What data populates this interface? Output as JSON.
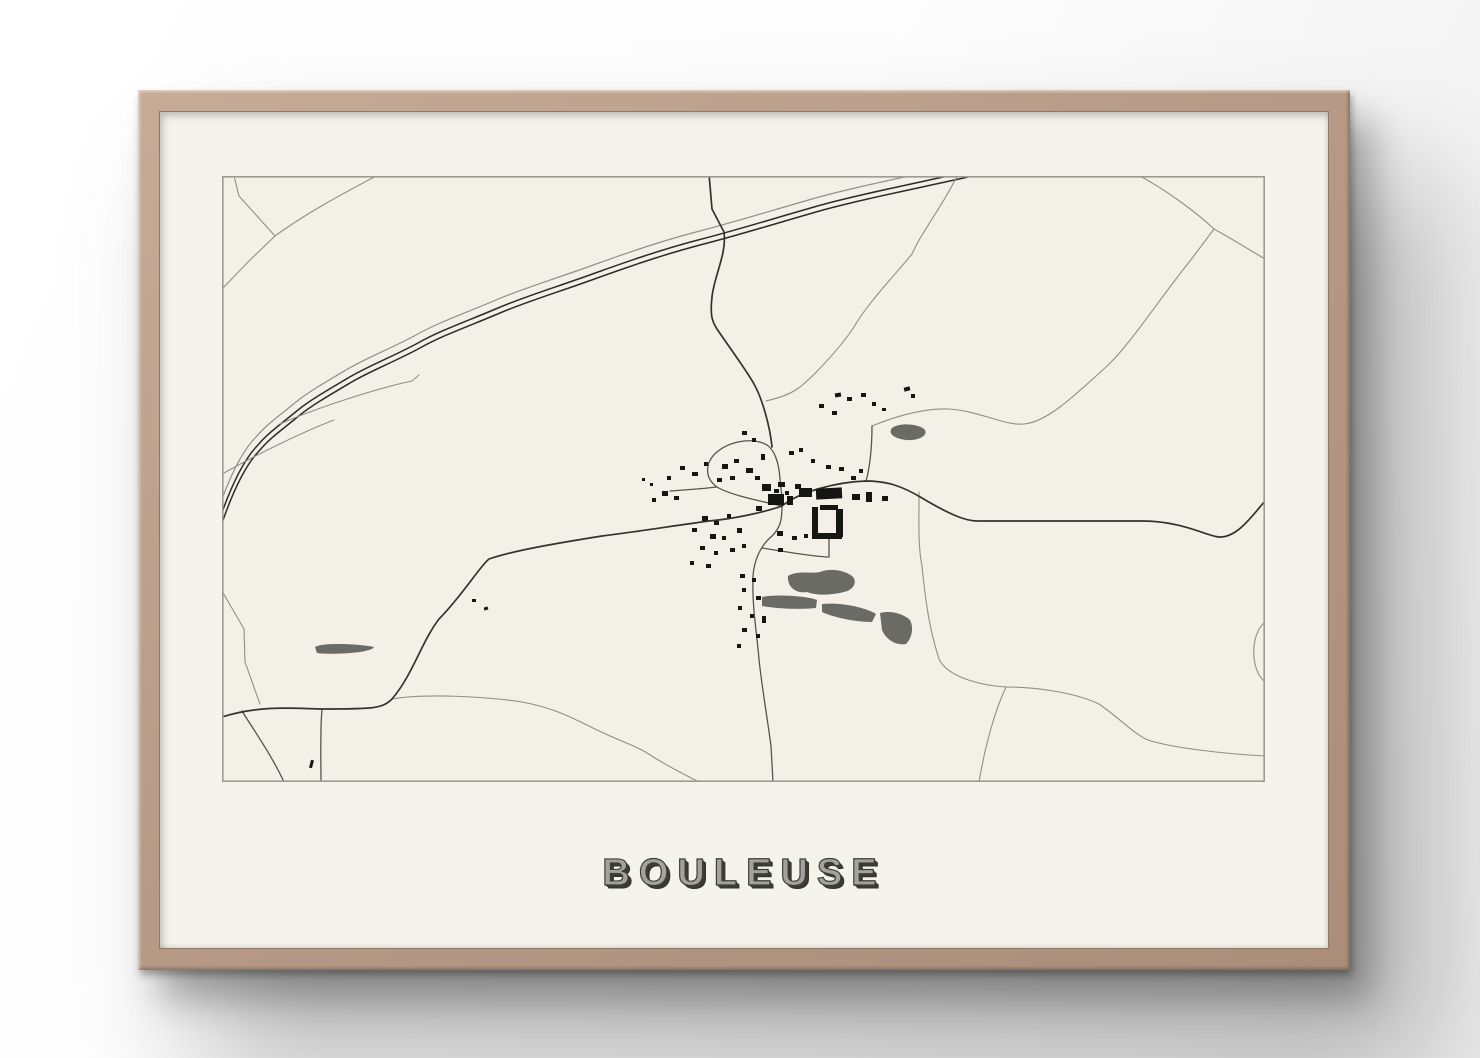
{
  "poster": {
    "title": "BOULEUSE"
  },
  "map": {
    "colors": {
      "paper": "#f3f1e7",
      "poster_mat": "#f5f4ec",
      "frame_wood": "#b79b88",
      "border": "#9b9b93",
      "thin_road": "#8f8f87",
      "medium_road": "#55554e",
      "dark_road": "#33332e",
      "railway": "#2b2b27",
      "building": "#151512",
      "wood_area": "#6b6b66",
      "title_face": "#a3a39e",
      "title_shadow": "#2f2f2b"
    },
    "features": {
      "areas": [
        "M670,252 C678,246 698,248 703,254 C706,260 696,265 684,264 C674,263 665,258 670,252 Z",
        "M93,471 C100,466 140,468 152,471 C150,477 110,479 95,477 Z",
        "M566,400 C575,394 590,398 598,396 C608,392 622,394 630,400 C636,405 632,414 622,416 C610,419 595,420 585,416 C573,418 565,410 566,400 Z",
        "M540,421 C555,418 585,420 595,424 L594,432 C575,434 550,432 540,430 Z",
        "M600,428 C620,426 645,432 654,438 L650,446 C630,446 608,440 600,436 Z",
        "M658,437 C668,434 682,438 688,444 C692,452 690,462 684,468 C675,470 664,464 660,454 Z"
      ],
      "thin_roads": [
        "M12,0 L17,20 L53,60 L27,85 L0,113",
        "M53,60 C83,38 120,18 156,-1",
        "M0,415 L22,453 L23,486 L38,528",
        "M735,0 C722,28 700,55 690,78 C672,100 645,128 632,151 C618,172 592,200 578,211 C566,220 552,223 544,225",
        "M650,250 C672,241 700,232 727,233 C758,235 783,250 802,248 C824,246 848,224 884,191 C908,169 938,122 968,85 C977,73 986,61 992,53",
        "M992,53 C974,36 944,14 918,0",
        "M992,53 C1010,63 1028,74 1043,83",
        "M697,316 C697,350 696,370 700,390 C704,430 708,455 717,483 C725,500 755,509 784,511",
        "M784,511 C812,511 852,516 877,528 C900,544 912,558 926,564 C950,572 1005,578 1043,580",
        "M784,511 C774,532 764,565 757,606",
        "M170,523 C205,517 268,521 300,526 C332,532 348,541 367,550 C394,564 415,570 425,577 C448,592 466,600 477,606",
        "M1043,446 C1028,458 1028,494 1043,506"
      ],
      "medium_roads": [
        "M560,330 C538,325 508,319 495,311 C481,301 484,285 495,276 C508,265 531,261 545,269 C553,274 557,288 558,303 C559,316 561,324 560,330 Z",
        "M495,311 C478,313 462,314 448,315",
        "M644,305 C647,295 650,275 650,250",
        "M540,372 C570,377 595,381 607,381 L607,362",
        "M560,330 C560,345 558,352 550,360 C538,370 532,385 531,400 C530,430 534,450 537,483 C539,505 545,540 549,570 L551,606",
        "M100,533 C98,556 99,580 99,606",
        "M20,535 C33,556 50,580 62,606"
      ],
      "dark_roads": [
        "M487,-2 L490,33 L502,56 C505,78 492,100 490,121 C488,140 490,145 495,153 C505,168 525,195 532,208 C540,222 548,250 550,271",
        "M560,330 C577,316 614,306 644,305 C665,305 680,310 700,322 C730,340 745,345 755,345 L920,345 C960,345 985,360 997,361 C1015,362 1030,340 1043,325",
        "M560,330 C540,337 510,343 487,345 C450,350 420,355 380,360 C330,368 290,375 267,383 C258,390 240,420 217,443 C200,465 190,500 170,523 C160,533 150,533 100,533 C80,533 40,528 0,541"
      ],
      "railway": {
        "base": "M744,-4 C690,8 630,20 592,31 C540,46 508,56 476,64 C438,74 404,86 376,96 C338,110 304,120 276,132 C248,144 219,154 196,167 C168,182 146,190 126,202 C104,215 87,225 76,234 C59,248 46,257 36,269 C22,283 8,312 -4,348",
        "gray_offset": [
          -2,
          -8
        ],
        "dark_offsets": [
          [
            0,
            0
          ],
          [
            2,
            5
          ]
        ],
        "sidings": [
          "M58,248 C92,233 152,213 190,205 L197,199",
          "M2,297 C30,281 78,257 112,244"
        ]
      },
      "buildings": [
        [
          546,
          318,
          16,
          11,
          0
        ],
        [
          540,
          308,
          9,
          7,
          0
        ],
        [
          556,
          306,
          7,
          5,
          0
        ],
        [
          534,
          330,
          6,
          5,
          0
        ],
        [
          565,
          320,
          6,
          9,
          0
        ],
        [
          573,
          308,
          6,
          5,
          0
        ],
        [
          594,
          312,
          26,
          11,
          -3
        ],
        [
          577,
          312,
          13,
          9,
          0
        ],
        [
          590,
          331,
          6,
          30,
          0
        ],
        [
          590,
          357,
          30,
          6,
          0
        ],
        [
          614,
          333,
          7,
          28,
          0
        ],
        [
          598,
          329,
          18,
          5,
          0
        ],
        [
          630,
          318,
          8,
          6,
          0
        ],
        [
          644,
          316,
          6,
          10,
          0
        ],
        [
          660,
          320,
          6,
          5,
          0
        ],
        [
          500,
          288,
          6,
          5,
          0
        ],
        [
          512,
          283,
          5,
          4,
          0
        ],
        [
          524,
          292,
          7,
          5,
          0
        ],
        [
          533,
          300,
          5,
          4,
          0
        ],
        [
          539,
          278,
          4,
          6,
          0
        ],
        [
          495,
          302,
          5,
          4,
          0
        ],
        [
          508,
          300,
          5,
          4,
          0
        ],
        [
          520,
          255,
          5,
          4,
          0
        ],
        [
          530,
          262,
          4,
          4,
          0
        ],
        [
          458,
          290,
          5,
          4,
          0
        ],
        [
          470,
          296,
          6,
          4,
          0
        ],
        [
          482,
          286,
          4,
          4,
          0
        ],
        [
          445,
          300,
          4,
          4,
          0
        ],
        [
          440,
          315,
          6,
          5,
          0
        ],
        [
          452,
          320,
          5,
          4,
          0
        ],
        [
          430,
          322,
          4,
          4,
          0
        ],
        [
          420,
          302,
          3,
          3,
          0
        ],
        [
          428,
          307,
          3,
          3,
          0
        ],
        [
          480,
          340,
          6,
          5,
          0
        ],
        [
          492,
          345,
          5,
          4,
          0
        ],
        [
          505,
          338,
          4,
          4,
          0
        ],
        [
          470,
          352,
          5,
          4,
          0
        ],
        [
          488,
          358,
          6,
          5,
          0
        ],
        [
          500,
          360,
          4,
          4,
          0
        ],
        [
          515,
          352,
          5,
          5,
          0
        ],
        [
          478,
          370,
          5,
          4,
          0
        ],
        [
          492,
          375,
          4,
          4,
          0
        ],
        [
          508,
          372,
          5,
          4,
          0
        ],
        [
          520,
          368,
          4,
          4,
          0
        ],
        [
          468,
          385,
          4,
          4,
          0
        ],
        [
          484,
          388,
          5,
          4,
          0
        ],
        [
          518,
          398,
          5,
          4,
          0
        ],
        [
          530,
          402,
          4,
          4,
          0
        ],
        [
          520,
          412,
          4,
          4,
          0
        ],
        [
          534,
          420,
          5,
          4,
          0
        ],
        [
          516,
          430,
          4,
          4,
          0
        ],
        [
          528,
          438,
          4,
          4,
          0
        ],
        [
          520,
          452,
          5,
          4,
          0
        ],
        [
          534,
          458,
          4,
          4,
          0
        ],
        [
          515,
          468,
          4,
          4,
          0
        ],
        [
          540,
          440,
          4,
          7,
          0
        ],
        [
          555,
          355,
          6,
          5,
          0
        ],
        [
          570,
          360,
          5,
          4,
          0
        ],
        [
          582,
          358,
          4,
          4,
          0
        ],
        [
          556,
          372,
          5,
          4,
          0
        ],
        [
          613,
          217,
          6,
          4,
          -10
        ],
        [
          625,
          221,
          5,
          4,
          0
        ],
        [
          639,
          217,
          5,
          4,
          0
        ],
        [
          682,
          211,
          6,
          4,
          -15
        ],
        [
          689,
          218,
          4,
          4,
          0
        ],
        [
          597,
          228,
          5,
          4,
          0
        ],
        [
          610,
          235,
          5,
          4,
          0
        ],
        [
          567,
          275,
          5,
          4,
          0
        ],
        [
          577,
          272,
          4,
          4,
          0
        ],
        [
          589,
          283,
          4,
          4,
          0
        ],
        [
          604,
          289,
          5,
          4,
          0
        ],
        [
          617,
          291,
          5,
          4,
          0
        ],
        [
          629,
          300,
          5,
          4,
          0
        ],
        [
          637,
          293,
          4,
          4,
          0
        ],
        [
          552,
          313,
          5,
          4,
          0
        ],
        [
          563,
          315,
          4,
          4,
          0
        ],
        [
          650,
          226,
          4,
          4,
          0
        ],
        [
          660,
          232,
          4,
          3,
          0
        ],
        [
          250,
          423,
          4,
          3,
          0
        ],
        [
          262,
          431,
          4,
          3,
          -20
        ],
        [
          88,
          584,
          3,
          8,
          15
        ]
      ]
    }
  }
}
